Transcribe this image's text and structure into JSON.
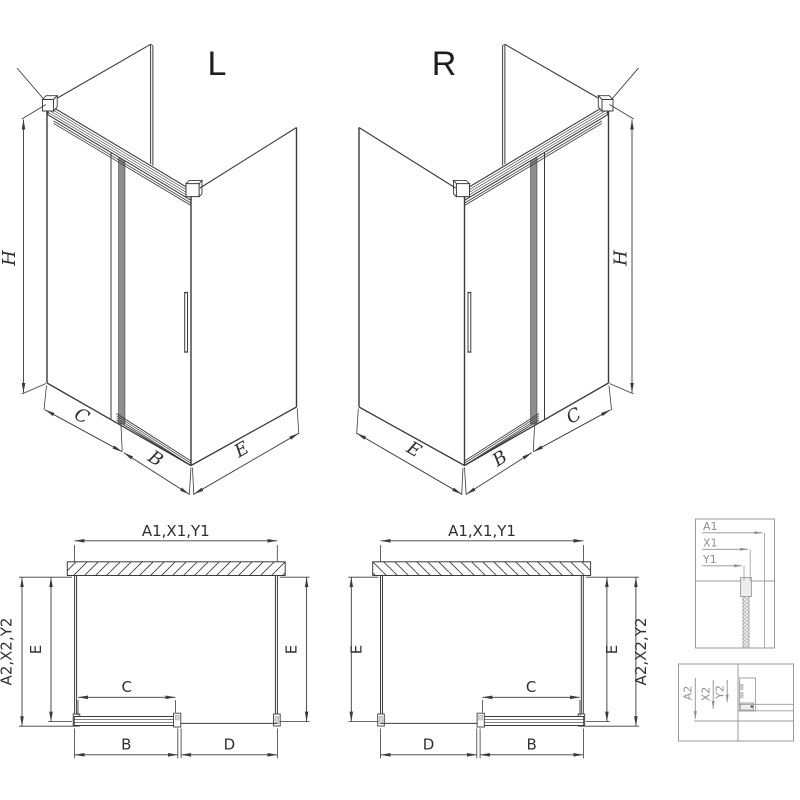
{
  "colors": {
    "line": "#3b3b3b",
    "door_profile": "#8e8e8e",
    "detail_gray": "#8f8f8f",
    "background": "#ffffff"
  },
  "views": {
    "iso_left": {
      "label": "L",
      "height_dim": "H",
      "fixed_width_dim": "C",
      "door_width_dim": "B",
      "side_depth_dim": "E"
    },
    "iso_right": {
      "label": "R",
      "height_dim": "H",
      "fixed_width_dim": "C",
      "door_width_dim": "B",
      "side_depth_dim": "E"
    },
    "plan_left": {
      "width_dim": "A1,X1,Y1",
      "depth_dim": "A2,X2,Y2",
      "side_left_dim": "E",
      "side_right_dim": "E",
      "door_glass_dim": "C",
      "door_rail_dim": "B",
      "fixed_panel_dim": "D"
    },
    "plan_right": {
      "width_dim": "A1,X1,Y1",
      "depth_dim": "A2,X2,Y2",
      "side_left_dim": "E",
      "side_right_dim": "E",
      "door_glass_dim": "C",
      "door_rail_dim": "B",
      "fixed_panel_dim": "D"
    },
    "detail_wall": {
      "labels": [
        "A1",
        "X1",
        "Y1"
      ]
    },
    "detail_floor": {
      "labels": [
        "A2",
        "X2",
        "Y2"
      ]
    }
  }
}
